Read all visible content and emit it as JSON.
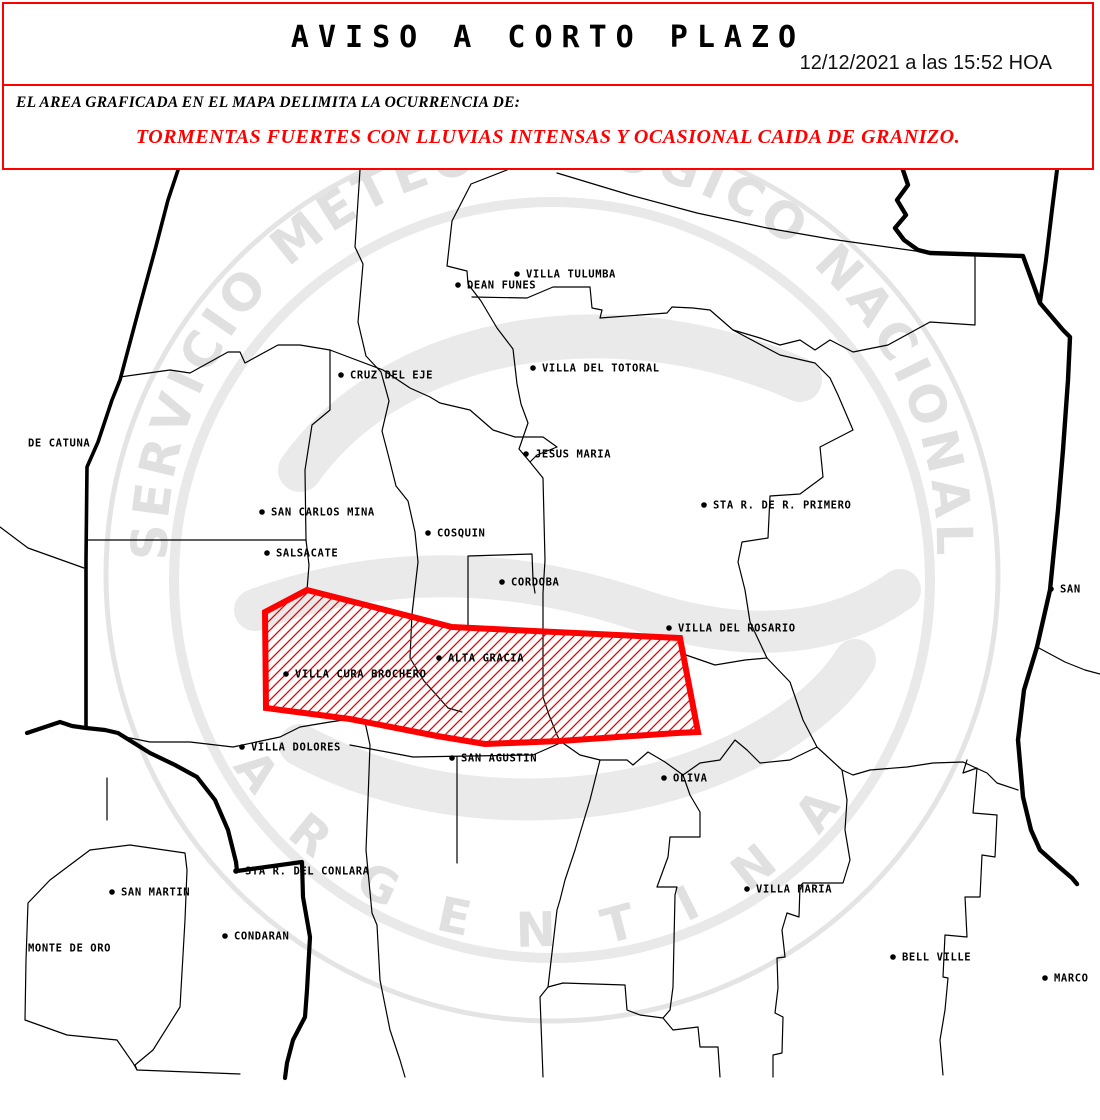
{
  "header": {
    "title": "AVISO A CORTO PLAZO",
    "timestamp": "12/12/2021 a las 15:52 HOA"
  },
  "notice": {
    "intro": "EL AREA GRAFICADA EN EL MAPA DELIMITA LA OCURRENCIA DE:",
    "warning": "TORMENTAS FUERTES CON LLUVIAS INTENSAS Y OCASIONAL CAIDA DE GRANIZO."
  },
  "colors": {
    "warning_red": "#ff0000",
    "map_line_black": "#000000",
    "watermark_gray": "#e4e4e4"
  },
  "watermark": {
    "arc_text": "SERVICIO METEOROLÓGICO NACIONAL",
    "bottom_text": "ARGENTINA"
  },
  "map": {
    "cities": [
      {
        "name": "VILLA TULUMBA",
        "x": 517,
        "y": 274,
        "dot": true
      },
      {
        "name": "DEAN FUNES",
        "x": 458,
        "y": 285,
        "dot": true
      },
      {
        "name": "CRUZ DEL EJE",
        "x": 341,
        "y": 375,
        "dot": true
      },
      {
        "name": "VILLA DEL TOTORAL",
        "x": 533,
        "y": 368,
        "dot": true
      },
      {
        "name": "JESUS MARIA",
        "x": 526,
        "y": 454,
        "dot": true
      },
      {
        "name": "DE CATUNA",
        "x": 28,
        "y": 443,
        "dot": false
      },
      {
        "name": "SAN CARLOS MINA",
        "x": 262,
        "y": 512,
        "dot": true
      },
      {
        "name": "SALSACATE",
        "x": 267,
        "y": 553,
        "dot": true
      },
      {
        "name": "COSQUIN",
        "x": 428,
        "y": 533,
        "dot": true
      },
      {
        "name": "STA R. DE R. PRIMERO",
        "x": 704,
        "y": 505,
        "dot": true
      },
      {
        "name": "CORDOBA",
        "x": 502,
        "y": 582,
        "dot": true
      },
      {
        "name": "SAN",
        "x": 1051,
        "y": 589,
        "dot": true
      },
      {
        "name": "VILLA DEL ROSARIO",
        "x": 669,
        "y": 628,
        "dot": true
      },
      {
        "name": "ALTA GRACIA",
        "x": 439,
        "y": 658,
        "dot": true
      },
      {
        "name": "VILLA CURA BROCHERO",
        "x": 286,
        "y": 674,
        "dot": true
      },
      {
        "name": "VILLA DOLORES",
        "x": 242,
        "y": 747,
        "dot": true
      },
      {
        "name": "SAN AGUSTIN",
        "x": 452,
        "y": 758,
        "dot": true
      },
      {
        "name": "OLIVA",
        "x": 664,
        "y": 778,
        "dot": true
      },
      {
        "name": "STA R. DEL CONLARA",
        "x": 236,
        "y": 871,
        "dot": true
      },
      {
        "name": "SAN MARTIN",
        "x": 112,
        "y": 892,
        "dot": true
      },
      {
        "name": "CONDARAN",
        "x": 225,
        "y": 936,
        "dot": true
      },
      {
        "name": "MONTE DE ORO",
        "x": 28,
        "y": 948,
        "dot": false
      },
      {
        "name": "VILLA MARIA",
        "x": 747,
        "y": 889,
        "dot": true
      },
      {
        "name": "BELL VILLE",
        "x": 893,
        "y": 957,
        "dot": true
      },
      {
        "name": "MARCO",
        "x": 1045,
        "y": 978,
        "dot": true
      }
    ]
  }
}
